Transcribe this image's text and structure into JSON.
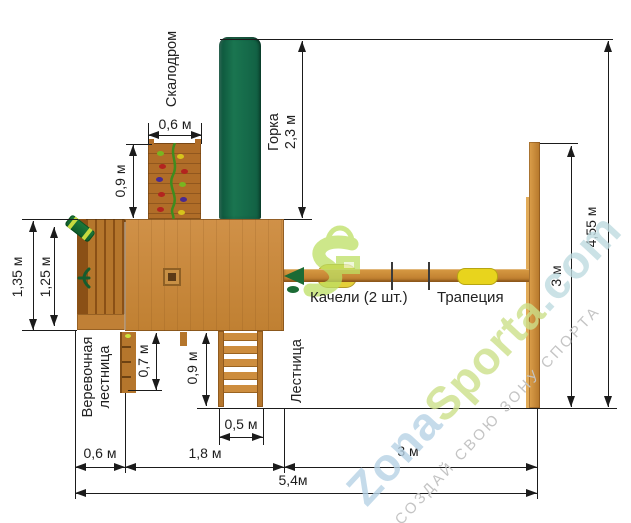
{
  "diagram": {
    "title": "Схема детской игровой площадки (вид сверху)",
    "labels": {
      "climbing_wall": "Скалодром",
      "slide_line1": "Горка",
      "slide_line2": "2,3 м",
      "swings": "Качели (2 шт.)",
      "trapeze": "Трапеция",
      "rope_ladder_line1": "Веревочная",
      "rope_ladder_line2": "лестница",
      "ladder": "Лестница"
    },
    "dimensions": {
      "climb_width": "0,6 м",
      "climb_height": "0,9 м",
      "balcony_outer": "1,35 м",
      "balcony_inner": "1,25 м",
      "rope_ladder_h": "0,7 м",
      "ladder_h": "0,9 м",
      "ladder_w": "0,5 м",
      "bottom_left": "0,6 м",
      "bottom_mid": "1,8 м",
      "bottom_right": "3 м",
      "total_width": "5,4м",
      "right_post": "3 м",
      "total_height": "4,55 м"
    },
    "watermark": {
      "brand_part1": "Zona",
      "brand_part2": "Sporta",
      "brand_part3": ".com",
      "slogan": "СОЗДАЙ СВОЮ ЗОНУ СПОРТА"
    },
    "colors": {
      "wood_main": "#c9883e",
      "wood_dark": "#8a5016",
      "slide_green": "#14674a",
      "logo_green": "#bddf63",
      "trapeze_yellow": "#e8d41d",
      "dim_line": "#1b1b1b",
      "wm_blue": "#b7d3e6",
      "wm_green": "#cde08a"
    }
  }
}
